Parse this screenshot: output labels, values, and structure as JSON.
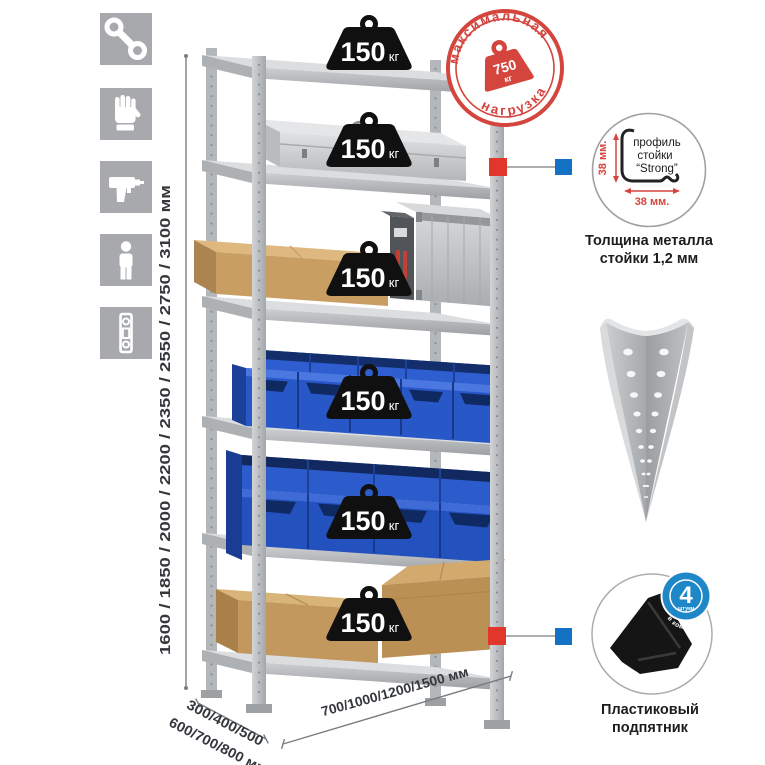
{
  "stamp": {
    "arc_top": "максимальная",
    "arc_bottom": "нагрузка",
    "weight_value": "750",
    "weight_unit": "кг"
  },
  "shelf_badges": [
    {
      "value": "150",
      "unit": "кг"
    },
    {
      "value": "150",
      "unit": "кг"
    },
    {
      "value": "150",
      "unit": "кг"
    },
    {
      "value": "150",
      "unit": "кг"
    },
    {
      "value": "150",
      "unit": "кг"
    },
    {
      "value": "150",
      "unit": "кг"
    }
  ],
  "dimensions": {
    "height": "1600 / 1850 / 2000 / 2200 / 2350 / 2550 / 2750 / 3100 мм",
    "depth_line1": "300/400/500",
    "depth_line2": "600/700/800 мм",
    "width": "700/1000/1200/1500 мм"
  },
  "profile_detail": {
    "label_line1": "профиль",
    "label_line2": "стойки",
    "label_line3": "“Strong”",
    "dim_vertical": "38 мм.",
    "dim_horizontal": "38 мм.",
    "caption_line1": "Толщина металла",
    "caption_line2": "стойки 1,2 мм"
  },
  "foot_detail": {
    "badge_value": "4",
    "badge_subtext": "штуки",
    "badge_arc_text": "в комплекте",
    "caption_line1": "Пластиковый",
    "caption_line2": "подпятник"
  },
  "sidebar_icons": [
    {
      "name": "wrench-icon"
    },
    {
      "name": "gloves-icon"
    },
    {
      "name": "drill-icon"
    },
    {
      "name": "person-icon"
    },
    {
      "name": "level-icon"
    }
  ],
  "colors": {
    "stamp_red": "#d4453e",
    "marker_red": "#e2352b",
    "marker_blue": "#1472c4",
    "bin_blue": "#2857c8",
    "cardboard": "#c89e63",
    "metal_light": "#d8dadc",
    "icon_tile_gray": "#a7a9ac",
    "badge_black": "#101010"
  }
}
